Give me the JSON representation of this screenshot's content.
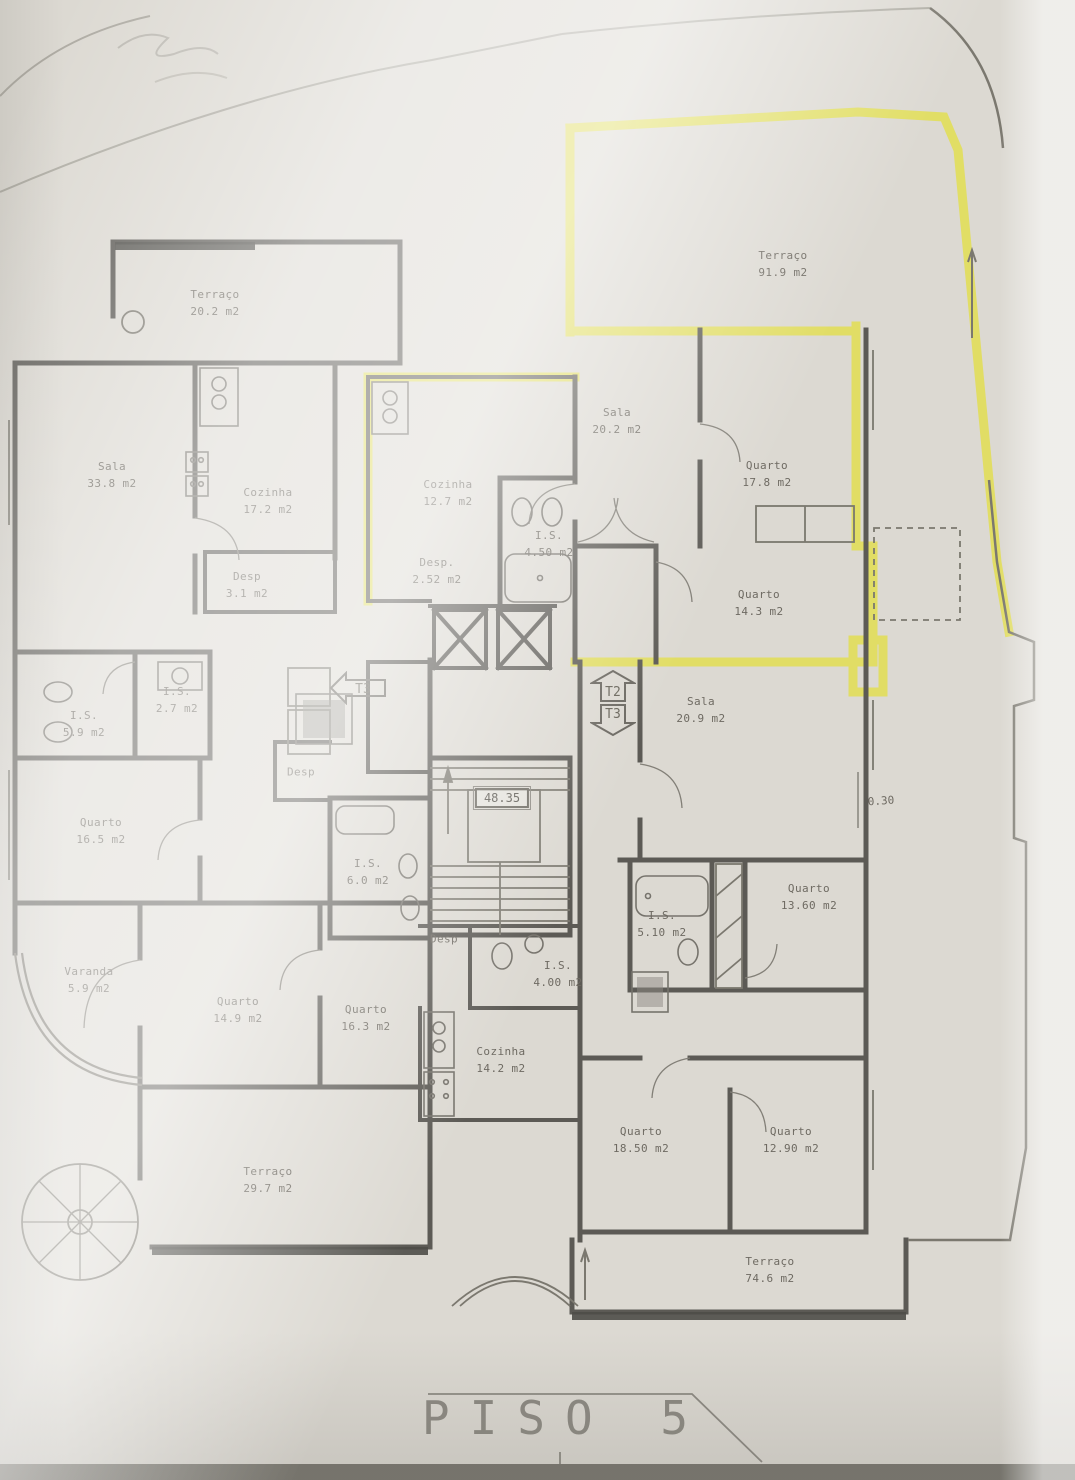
{
  "title": "PISO 5",
  "colors": {
    "highlight_wall": "#e2de52",
    "wall": "#5c5a55",
    "paper": "#dcd9d2"
  },
  "stairwell": {
    "elevation_label": "48.35"
  },
  "dimension_label": "0.30",
  "unit_markers": [
    {
      "label": "T3",
      "direction": "left"
    },
    {
      "label": "T2",
      "direction": "up"
    },
    {
      "label": "T3",
      "direction": "down"
    }
  ],
  "rooms": [
    {
      "name": "Terraço",
      "area": "20.2 m2"
    },
    {
      "name": "Terraço",
      "area": "91.9 m2"
    },
    {
      "name": "Sala",
      "area": "33.8 m2"
    },
    {
      "name": "Cozinha",
      "area": "17.2 m2"
    },
    {
      "name": "Cozinha",
      "area": "12.7 m2"
    },
    {
      "name": "Desp.",
      "area": "2.52 m2"
    },
    {
      "name": "I.S.",
      "area": "4.50 m2"
    },
    {
      "name": "Sala",
      "area": "20.2 m2"
    },
    {
      "name": "Quarto",
      "area": "17.8 m2"
    },
    {
      "name": "Quarto",
      "area": "14.3 m2"
    },
    {
      "name": "Desp",
      "area": "3.1 m2"
    },
    {
      "name": "I.S.",
      "area": "2.7 m2"
    },
    {
      "name": "I.S.",
      "area": "5.9 m2"
    },
    {
      "name": "Sala",
      "area": "20.9 m2"
    },
    {
      "name": "Quarto",
      "area": "16.5 m2"
    },
    {
      "name": "Desp",
      "area": ""
    },
    {
      "name": "I.S.",
      "area": "6.0 m2"
    },
    {
      "name": "Quarto",
      "area": "13.60 m2"
    },
    {
      "name": "I.S.",
      "area": "5.10 m2"
    },
    {
      "name": "Varanda",
      "area": "5.9 m2"
    },
    {
      "name": "Quarto",
      "area": "14.9 m2"
    },
    {
      "name": "Quarto",
      "area": "16.3 m2"
    },
    {
      "name": "Desp",
      "area": ""
    },
    {
      "name": "I.S.",
      "area": "4.00 m2"
    },
    {
      "name": "Cozinha",
      "area": "14.2 m2"
    },
    {
      "name": "Quarto",
      "area": "18.50 m2"
    },
    {
      "name": "Quarto",
      "area": "12.90 m2"
    },
    {
      "name": "Terraço",
      "area": "29.7 m2"
    },
    {
      "name": "Terraço",
      "area": "74.6 m2"
    }
  ]
}
